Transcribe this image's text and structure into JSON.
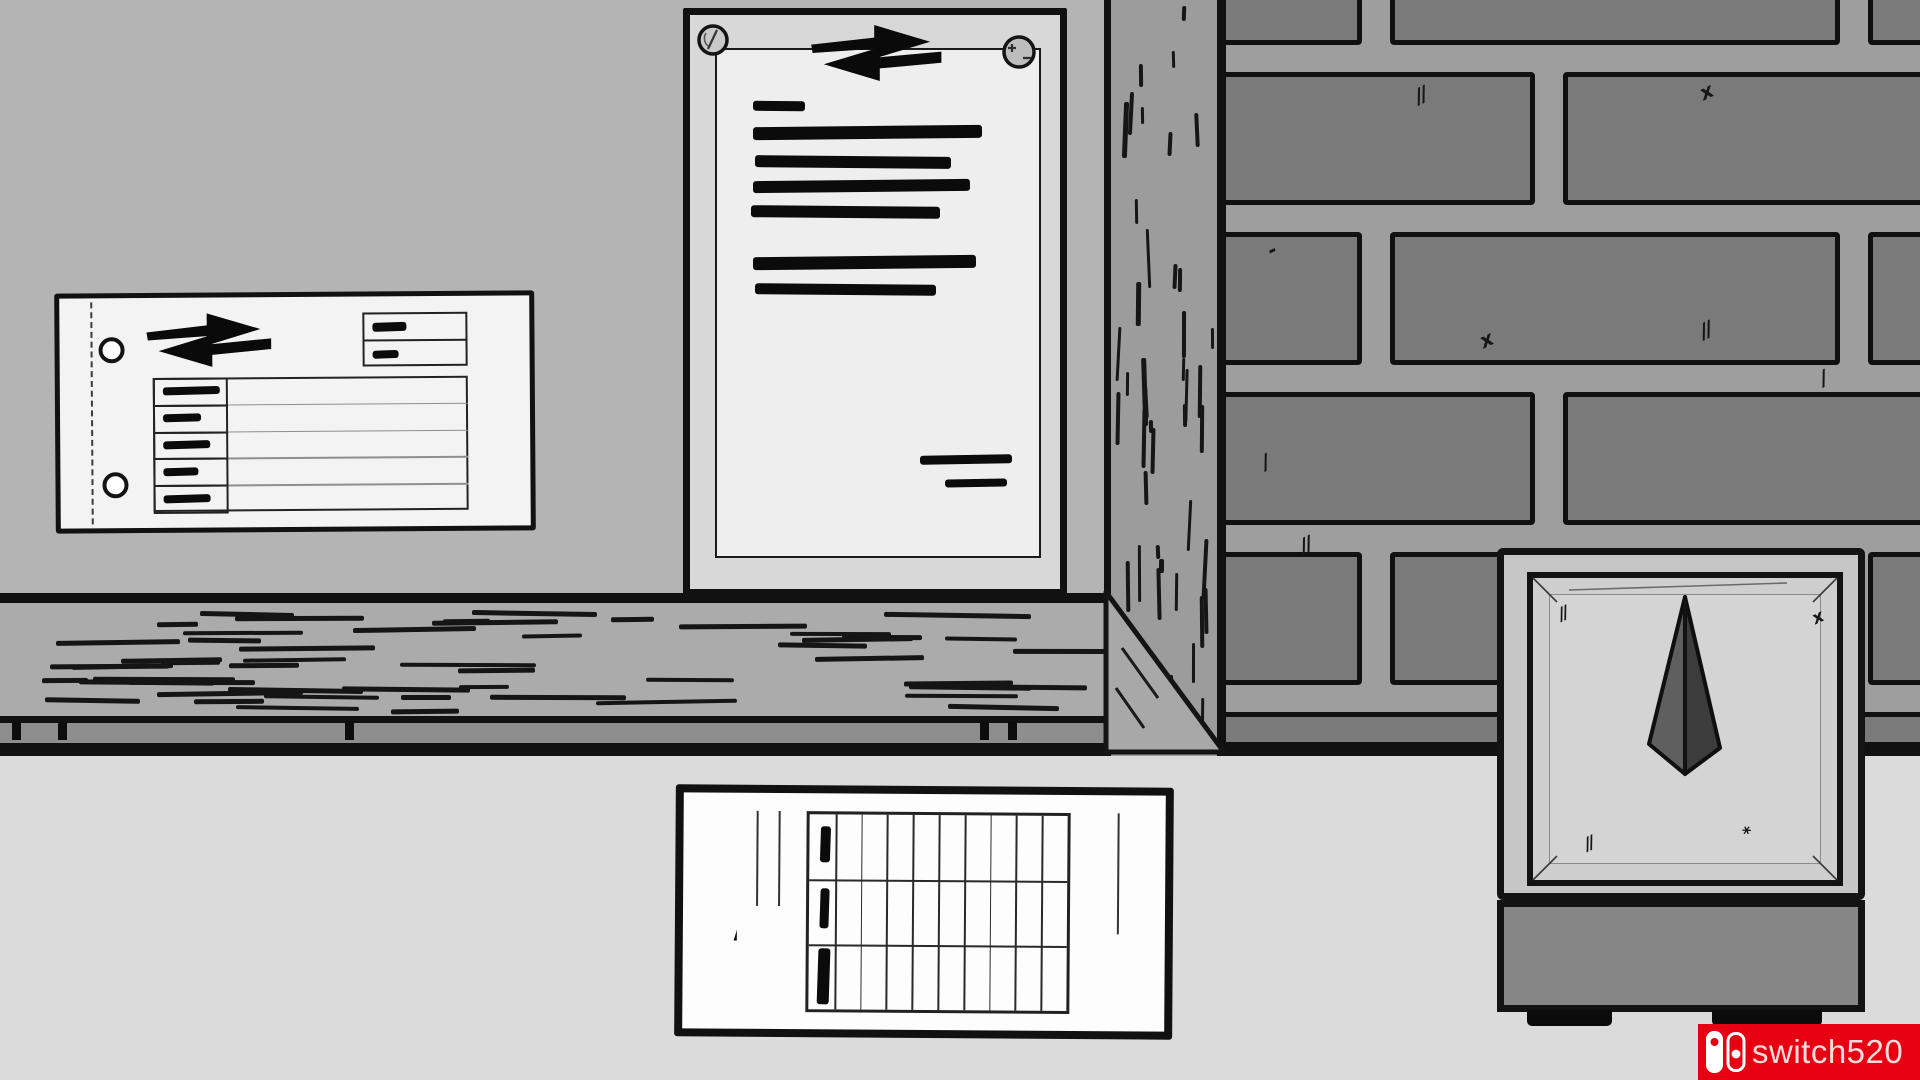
{
  "watermark": {
    "text": "switch520",
    "icon": "nintendo-switch-logo",
    "bg": "#e60012",
    "text_color": "#ffdcdc"
  },
  "palette": {
    "wall": "#b4b4b4",
    "wood_post": "#9c9c9c",
    "brick": "#7a7a7a",
    "mortar": "#9e9e9e",
    "shelf": "#ababab",
    "shelf_shadow": "#8e8e8e",
    "desk": "#dbdbdb",
    "ink": "#111111",
    "board": "#d8d8d8",
    "paper": "#eeeeee",
    "note": "#f3f3f3",
    "card": "#fdfdfd",
    "device_face": "#c6c6c6",
    "device_panel": "#cfcfcf",
    "device_inner": "#d4d4d4",
    "device_base": "#868686",
    "pyramid_light": "#5f5f5f",
    "pyramid_dark": "#3c3c3c",
    "red": "#e60012",
    "wm_text": "#ffdcdc"
  },
  "scene": {
    "shelf": {
      "ticks": [
        12,
        58,
        345,
        980,
        1008
      ]
    },
    "bricks": {
      "brick_w": 450,
      "gap": 28,
      "rows": [
        {
          "y": -12,
          "h": 57,
          "offset": -314
        },
        {
          "y": 72,
          "h": 133,
          "offset": -141
        },
        {
          "y": 232,
          "h": 133,
          "offset": -314
        },
        {
          "y": 392,
          "h": 133,
          "offset": -141
        },
        {
          "y": 552,
          "h": 133,
          "offset": -314
        },
        {
          "y": 712,
          "h": 60,
          "offset": -141
        }
      ],
      "scratches": [
        [
          189,
          85,
          "//"
        ],
        [
          474,
          82,
          "x"
        ],
        [
          42,
          240,
          "-"
        ],
        [
          474,
          320,
          "//"
        ],
        [
          594,
          368,
          "/"
        ],
        [
          254,
          330,
          "x"
        ],
        [
          74,
          535,
          "//"
        ],
        [
          392,
          680,
          "//"
        ],
        [
          626,
          628,
          "-"
        ],
        [
          36,
          452,
          "/"
        ]
      ]
    },
    "wall_note": {
      "hole_centers": [
        [
          52,
          52
        ],
        [
          55,
          187
        ]
      ],
      "head_box": {
        "x": 303,
        "y": 16,
        "w": 105,
        "h": 54,
        "dashes": [
          [
            10,
            10,
            34,
            9
          ],
          [
            10,
            38,
            26,
            8
          ]
        ]
      },
      "table": {
        "x": 93,
        "y": 80,
        "w": 315,
        "h": 134,
        "rows": 5,
        "left_col_w": 75,
        "label_dashes": [
          57,
          38,
          47,
          35,
          47
        ]
      }
    },
    "pinned_document": {
      "pins": [
        "slotted-screw-pin",
        "plus-minus-screw-pin"
      ],
      "redacted_lines": [
        [
          63,
          86,
          52,
          10
        ],
        [
          63,
          111,
          229,
          13
        ],
        [
          65,
          141,
          196,
          12
        ],
        [
          63,
          165,
          217,
          12
        ],
        [
          61,
          191,
          189,
          12
        ],
        [
          63,
          241,
          223,
          13
        ],
        [
          65,
          269,
          181,
          11
        ]
      ],
      "signature_lines": [
        [
          230,
          440,
          92,
          9
        ],
        [
          255,
          464,
          62,
          8
        ]
      ]
    },
    "punch_card": {
      "guides": [
        [
          73,
          18,
          95
        ],
        [
          95,
          18,
          95
        ],
        [
          434,
          18,
          121
        ]
      ],
      "grid": {
        "cols": 10,
        "rows": 3
      },
      "marks": [
        [
          11,
          12,
          10,
          36
        ],
        [
          11,
          74,
          9,
          40
        ],
        [
          9,
          134,
          12,
          56
        ]
      ]
    },
    "device": {
      "scratches": [
        [
          62,
          58,
          "//"
        ],
        [
          316,
          62,
          "x"
        ],
        [
          88,
          288,
          "//"
        ],
        [
          247,
          278,
          "*"
        ]
      ]
    }
  }
}
